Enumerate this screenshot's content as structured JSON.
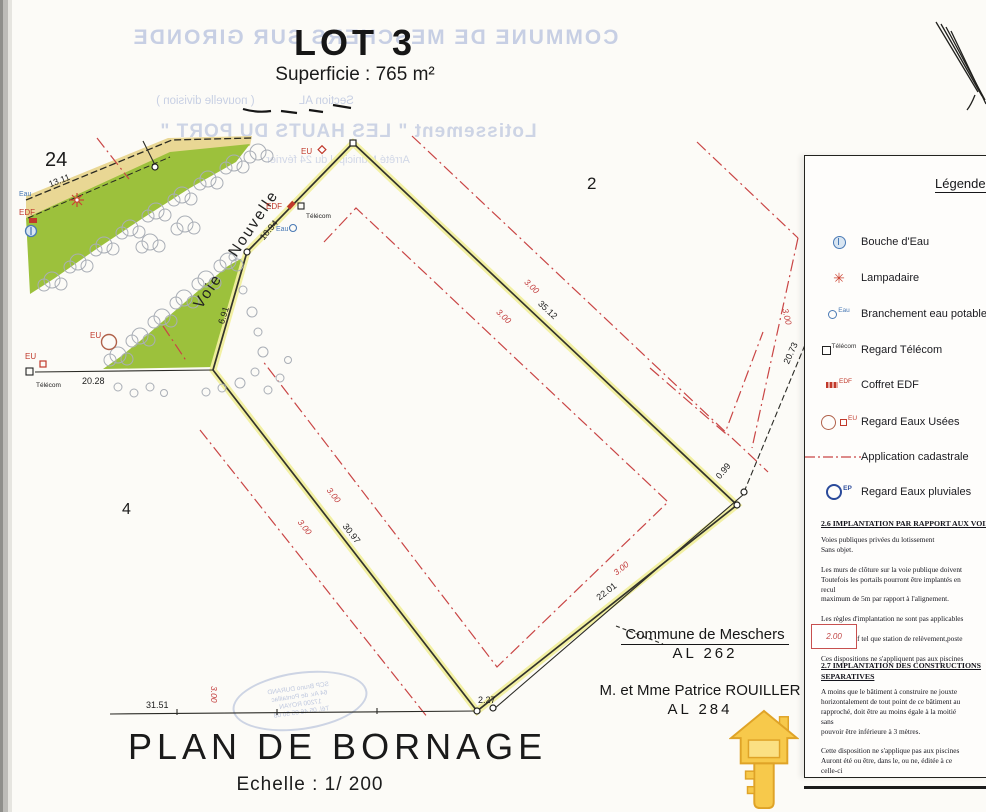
{
  "header": {
    "lot_title": "LOT 3",
    "superficie": "Superficie : 765 m²"
  },
  "ghost": {
    "commune": "COMMUNE DE MESCHERS SUR GIRONDE",
    "section": "Section AL              ( nouvelle division )",
    "lotissement": "Lotissement \" LES HAUTS DU PORT \"",
    "arrete": "Arrêté Municipal du 24 février",
    "stamp": "SCP Bruno DURAND\n64 Av. de Pontaillac\n17200 ROYAN\nTél. 05 46 05 50 08"
  },
  "plan": {
    "street": "Voie Nouvelle",
    "parcels": {
      "p24": "24",
      "p2": "2",
      "p4": "4"
    },
    "offset_label": "3.00",
    "dims": {
      "d1311": "13.11",
      "d2028": "20.28",
      "d1094": "10.94",
      "d691": "6.91",
      "d3512": "35.12",
      "d3097": "30.97",
      "d2201": "22.01",
      "d2073": "20.73",
      "d099": "0.99",
      "d227": "2.27",
      "d3151": "31.51"
    },
    "utilities": {
      "eu": "EU",
      "edf": "EDF",
      "eau": "Eau",
      "telecom": "Télécom"
    },
    "annotations": {
      "commune": "Commune de Meschers",
      "commune_ref": "AL  262",
      "owner": "M. et Mme Patrice ROUILLER",
      "owner_ref": "AL  284"
    }
  },
  "legend": {
    "title": "Légende",
    "items": [
      {
        "label": "Bouche d'Eau"
      },
      {
        "label": "Lampadaire"
      },
      {
        "label": "Branchement eau potable",
        "tag": "Eau"
      },
      {
        "label": "Regard Télécom",
        "tag": "Télécom"
      },
      {
        "label": "Coffret EDF",
        "tag": "EDF"
      },
      {
        "label": "Regard Eaux Usées",
        "tag": "EU"
      },
      {
        "label": "Application cadastrale"
      },
      {
        "label": "Regard Eaux pluviales",
        "tag": "EP"
      }
    ],
    "lamp_glyph": "✳"
  },
  "notes": {
    "sec26_head": "2.6 IMPLANTATION PAR RAPPORT AUX VOIES",
    "sec26_body": "Voies publiques privées du lotissement\nSans objet.\n\nLes murs de clôture sur la voie publique doivent\nToutefois les portails pourront être implantés en\nrecul\nmaximum de 5m par rapport à l'alignement.\n\nLes règles d'implantation ne sont pas applicables\n        ou\n        collectif tel que station de relèvement,poste\n\nCes dispositions ne s'appliquent pas aux piscines",
    "symbol_value": "2.00",
    "sec27_head": "2.7 IMPLANTATION DES CONSTRUCTIONS",
    "sec27_head2": "SEPARATIVES",
    "sec27_body": "A moins que le bâtiment à construire ne jouxte\nhorizontalement de tout point de ce bâtiment au\nrapproché, doit être au moins égale à la moitié\nsans\npouvoir être inférieure à 3 mètres.\n\nCette disposition ne s'applique pas aux piscines\nAuront été ou être, dans le, ou ne, éditée à ce\ncelle-ci\nConsidération nouvelle de la propriété. Il n'est p\nTechnique d'utilité publique"
  },
  "footer": {
    "title": "PLAN  DE  BORNAGE",
    "scale": "Echelle  : 1/ 200"
  },
  "colors": {
    "boundary_yellow": "#f1ef9e",
    "vegetation_green": "#9cc13c",
    "band_tan": "#e9d794",
    "cadastral_red": "#c94545",
    "water_blue": "#4a7ab5",
    "key_gold": "#f7c94b"
  }
}
